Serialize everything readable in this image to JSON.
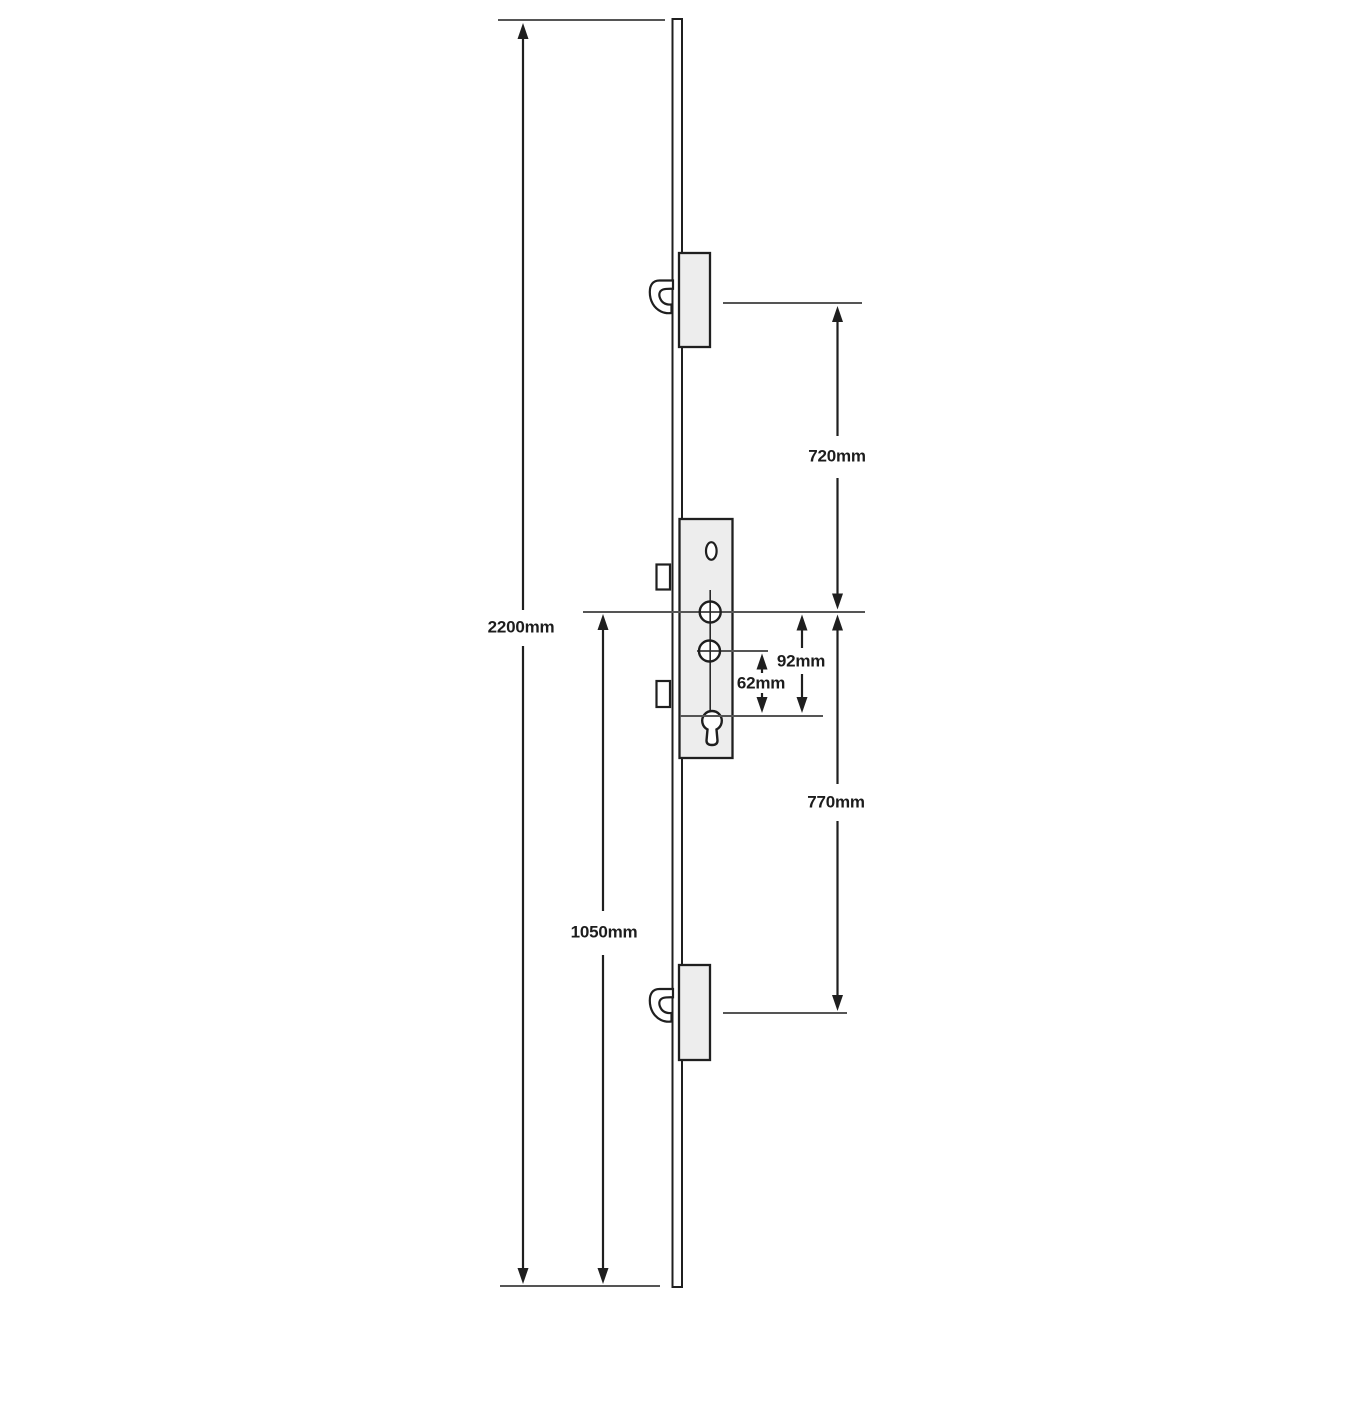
{
  "diagram": {
    "labels": {
      "total_height": "2200mm",
      "top_hook_to_centre": "720mm",
      "centre_to_bottom": "1050mm",
      "centre_to_bottom_hook": "770mm",
      "centre_to_cylinder": "92mm",
      "handle_to_cylinder": "62mm"
    },
    "colors": {
      "outline": "#1f1f1f",
      "datum_line": "#555555",
      "panel_fill": "#ededed",
      "background": "#ffffff"
    }
  }
}
